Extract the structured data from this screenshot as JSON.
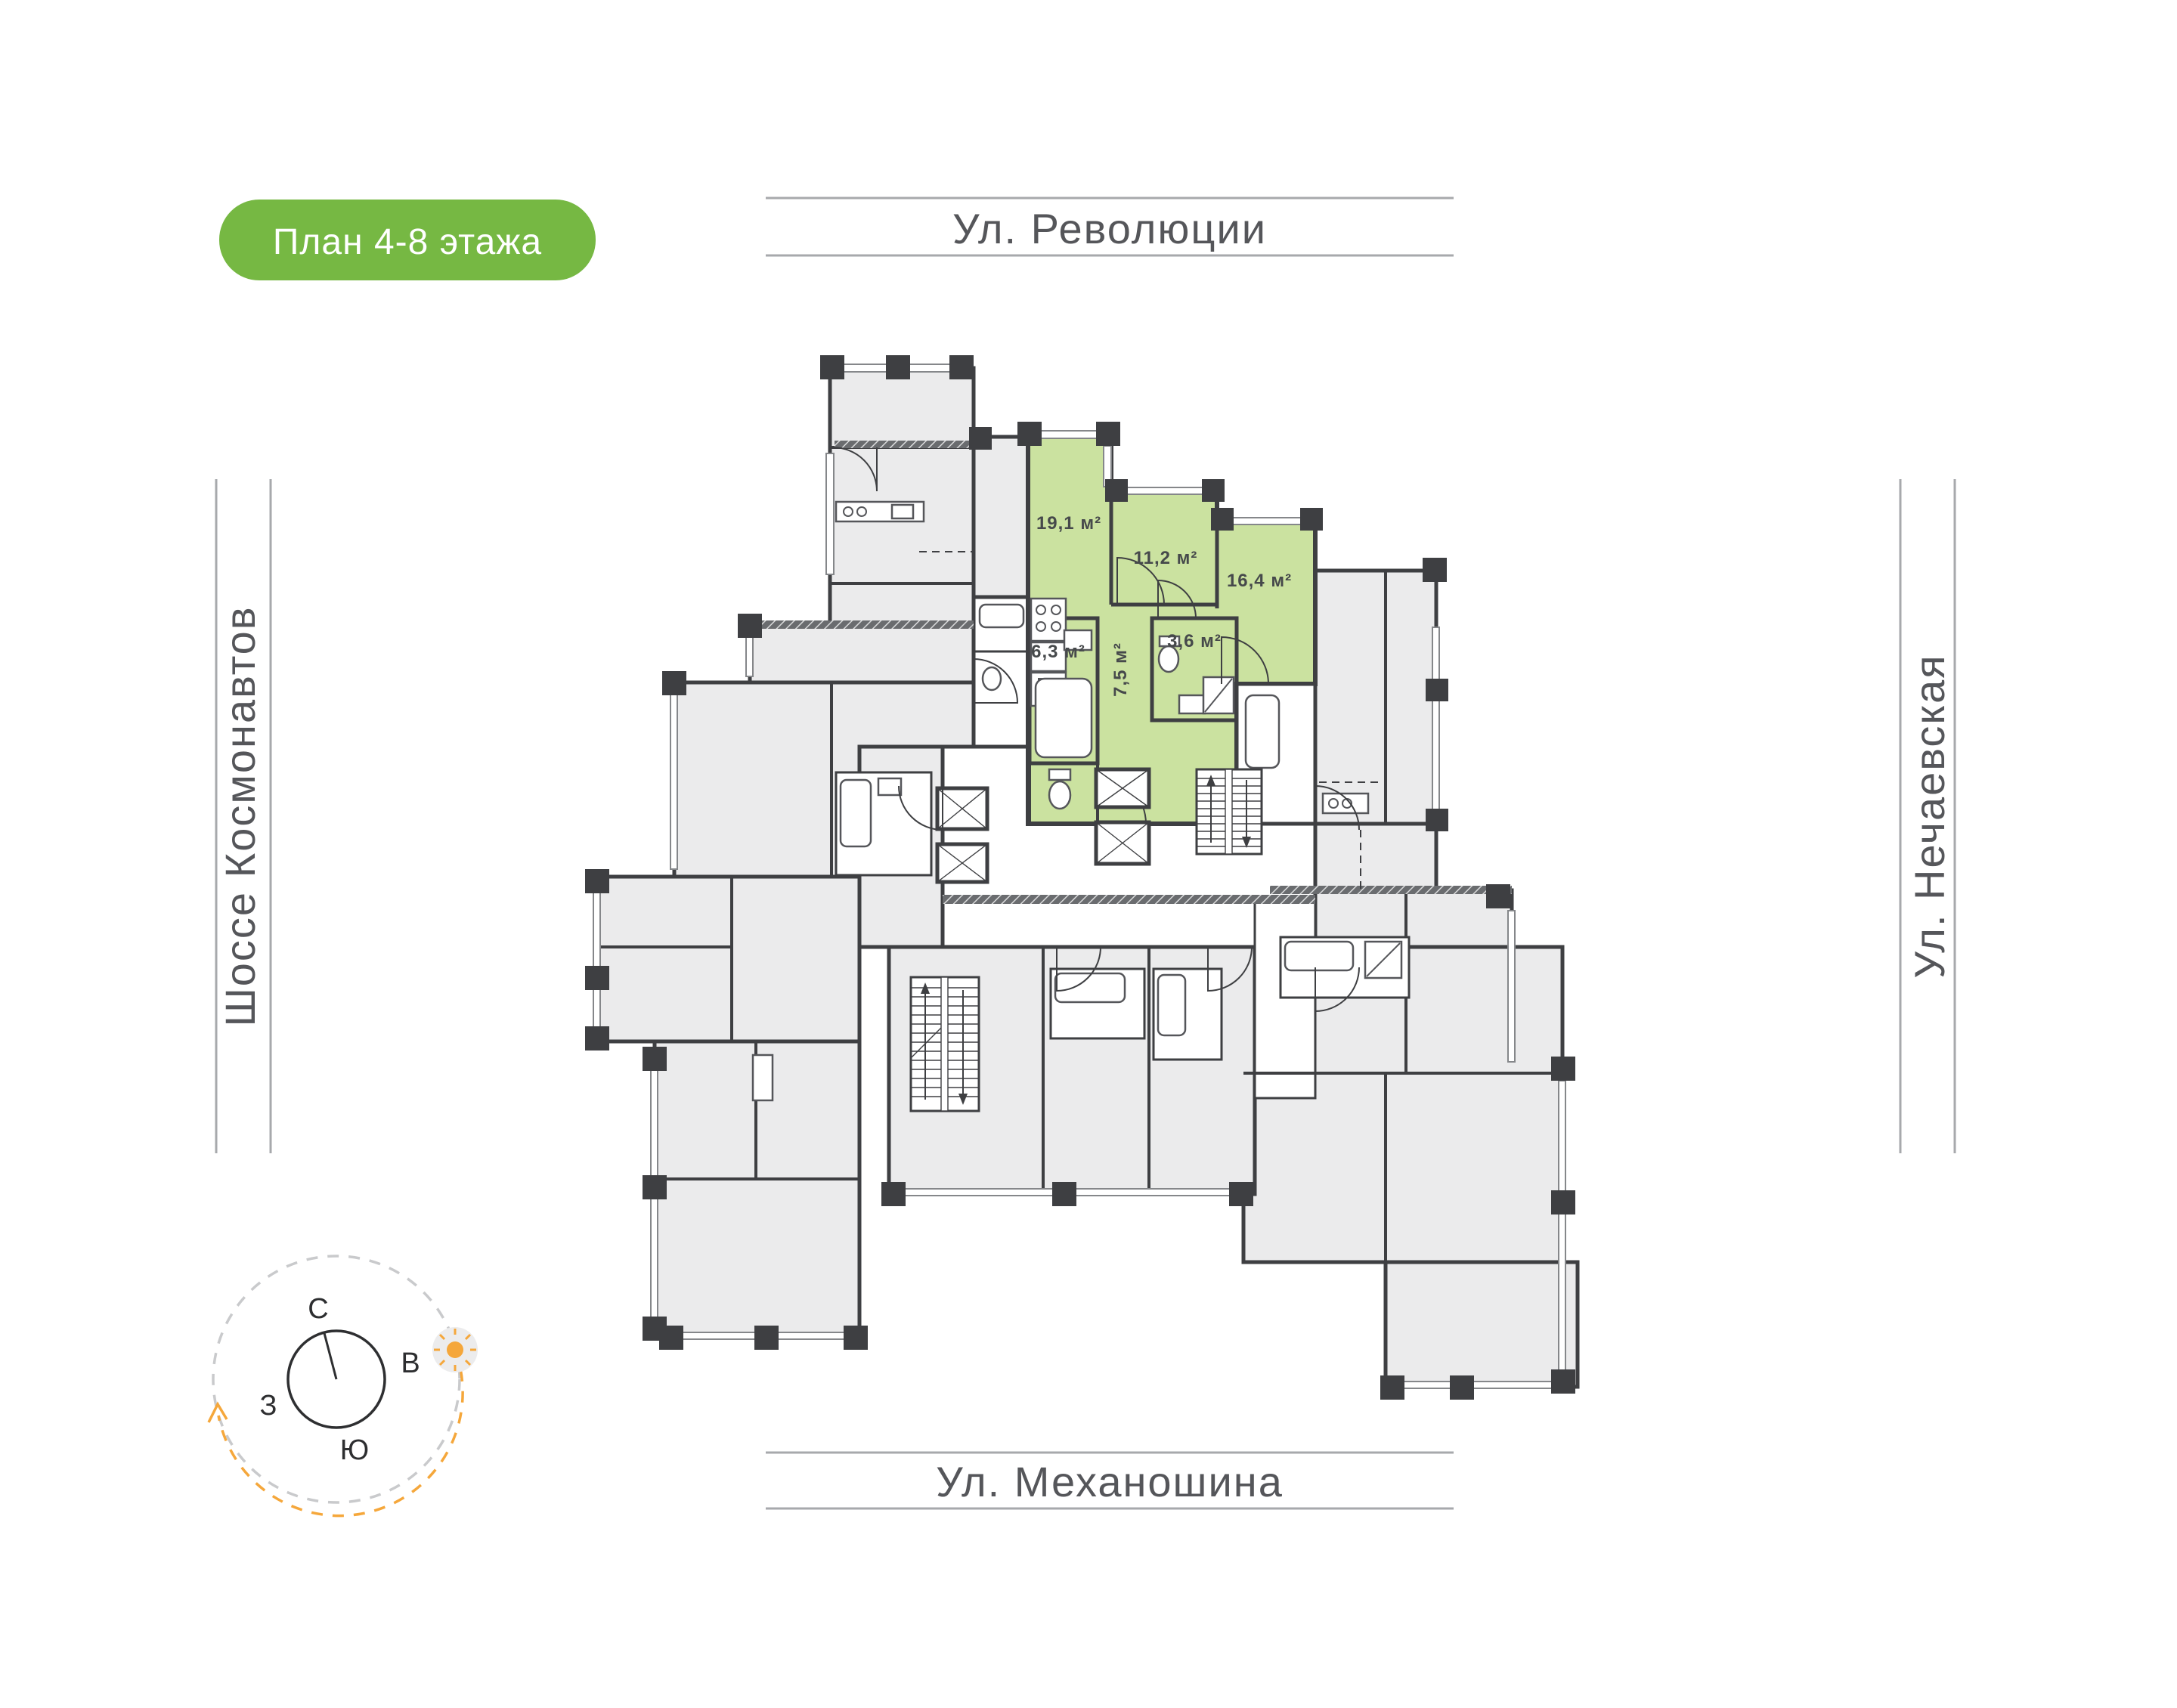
{
  "badge": {
    "label": "План 4-8 этажа"
  },
  "streets": {
    "top": "Ул. Революции",
    "bottom": "Ул. Механошина",
    "left": "Шоссе Космонавтов",
    "right": "Ул. Нечаевская"
  },
  "highlighted_apartment": {
    "rooms": [
      {
        "name": "living-room",
        "area": "19,1 м²"
      },
      {
        "name": "bedroom",
        "area": "11,2 м²"
      },
      {
        "name": "bedroom-2",
        "area": "16,4 м²"
      },
      {
        "name": "bathroom",
        "area": "6,3 м²"
      },
      {
        "name": "wc",
        "area": "3,6 м²"
      },
      {
        "name": "hallway",
        "area": "7,5 м²"
      }
    ]
  },
  "compass": {
    "north": "С",
    "east": "В",
    "south": "Ю",
    "west": "З"
  },
  "colors": {
    "badge_green": "#76b843",
    "apartment_green": "#cbe2a0",
    "wall": "#3e3f42",
    "apartment_gray": "#ebebec",
    "street_text": "#55565a",
    "street_line": "#a7a9ac",
    "compass_orange": "#f5a73b"
  }
}
